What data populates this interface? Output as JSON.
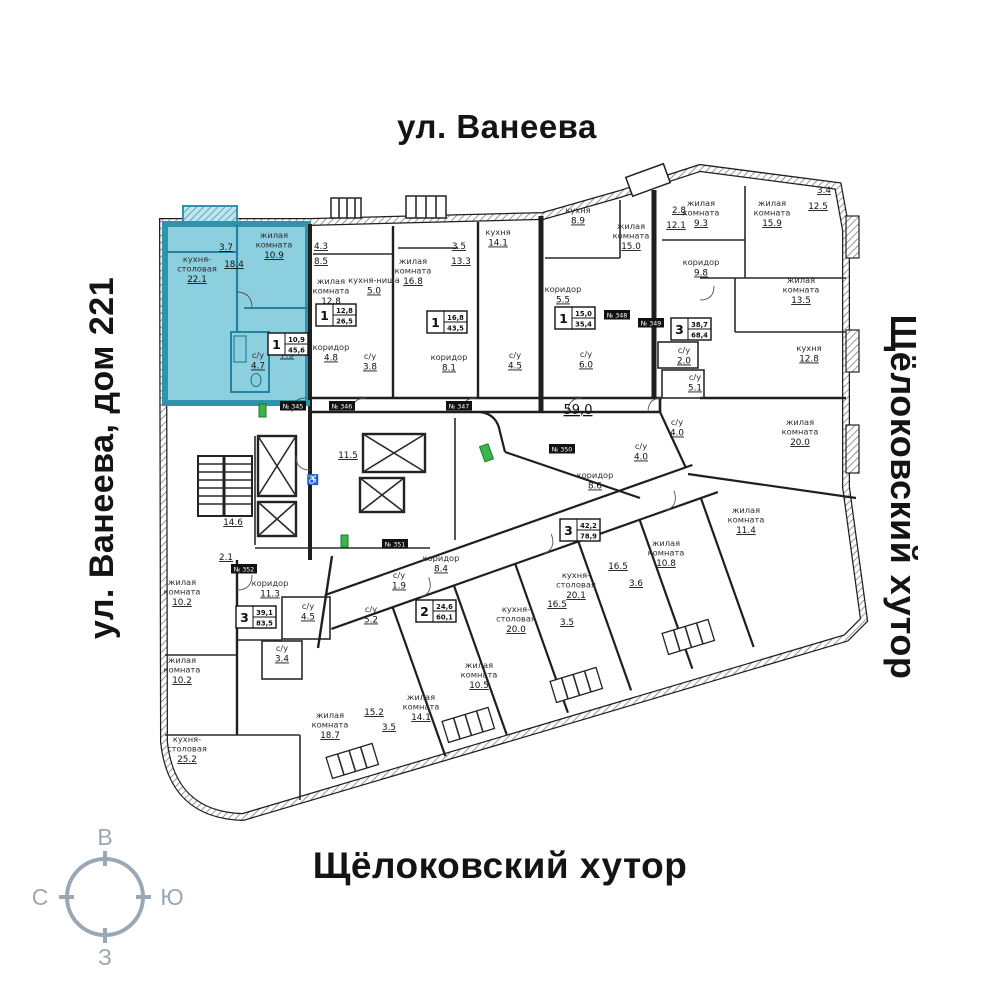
{
  "streets": {
    "top": "ул. Ванеева",
    "left": "ул. Ванеева, дом 221",
    "right": "Щёлоковский хутор",
    "bottom": "Щёлоковский хутор"
  },
  "compass": {
    "top": "В",
    "right": "Ю",
    "bottom": "З",
    "left": "С"
  },
  "colors": {
    "highlight_fill": "#7cc8da",
    "highlight_wall": "#2f93ac",
    "exit_green": "#3cb54a",
    "wall": "#1f1f1f",
    "compass": "#9aa7b4"
  },
  "plan": {
    "rooms": [
      {
        "name": "кухня-\nстоловая",
        "area": "22.1",
        "x": 197,
        "y": 262
      },
      {
        "name": "жилая\nкомната",
        "area": "10.9",
        "x": 274,
        "y": 238
      },
      {
        "area": "3.7",
        "x": 226,
        "y": 250
      },
      {
        "area": "18.4",
        "x": 234,
        "y": 267
      },
      {
        "name": "коридор",
        "area": "7.9",
        "x": 287,
        "y": 347
      },
      {
        "name": "с/у",
        "area": "4.7",
        "x": 258,
        "y": 358
      },
      {
        "area": "4.3",
        "x": 321,
        "y": 249
      },
      {
        "area": "8.5",
        "x": 321,
        "y": 264
      },
      {
        "name": "жилая\nкомната",
        "area": "12.8",
        "x": 331,
        "y": 284
      },
      {
        "name": "кухня-ниша",
        "area": "5.0",
        "x": 374,
        "y": 283
      },
      {
        "name": "коридор",
        "area": "4.8",
        "x": 331,
        "y": 350
      },
      {
        "name": "с/у",
        "area": "3.8",
        "x": 370,
        "y": 359
      },
      {
        "area": "3.5",
        "x": 459,
        "y": 249
      },
      {
        "area": "13.3",
        "x": 461,
        "y": 264
      },
      {
        "name": "жилая\nкомната",
        "area": "16.8",
        "x": 413,
        "y": 264
      },
      {
        "name": "коридор",
        "area": "8.1",
        "x": 449,
        "y": 360
      },
      {
        "name": "кухня",
        "area": "14.1",
        "x": 498,
        "y": 235
      },
      {
        "name": "с/у",
        "area": "4.5",
        "x": 515,
        "y": 358
      },
      {
        "name": "кухня",
        "area": "8.9",
        "x": 578,
        "y": 213
      },
      {
        "name": "жилая\nкомната",
        "area": "15.0",
        "x": 631,
        "y": 229
      },
      {
        "area": "2.8",
        "x": 679,
        "y": 213
      },
      {
        "area": "12.1",
        "x": 676,
        "y": 228
      },
      {
        "name": "коридор",
        "area": "5.5",
        "x": 563,
        "y": 292
      },
      {
        "name": "с/у",
        "area": "6.0",
        "x": 586,
        "y": 357
      },
      {
        "name": "жилая\nкомната",
        "area": "9.3",
        "x": 701,
        "y": 206
      },
      {
        "name": "жилая\nкомната",
        "area": "15.9",
        "x": 772,
        "y": 206
      },
      {
        "area": "3.4",
        "x": 824,
        "y": 193
      },
      {
        "area": "12.5",
        "x": 818,
        "y": 209
      },
      {
        "name": "коридор",
        "area": "9.8",
        "x": 701,
        "y": 265
      },
      {
        "name": "жилая\nкомната",
        "area": "13.5",
        "x": 801,
        "y": 283
      },
      {
        "name": "с/у",
        "area": "2.0",
        "x": 684,
        "y": 353
      },
      {
        "name": "с/у",
        "area": "5.1",
        "x": 695,
        "y": 380
      },
      {
        "name": "кухня",
        "area": "12.8",
        "x": 809,
        "y": 351
      },
      {
        "name": "жилая\nкомната",
        "area": "20.0",
        "x": 800,
        "y": 425
      },
      {
        "name": "с/у",
        "area": "4.0",
        "x": 677,
        "y": 425
      },
      {
        "name": "с/у",
        "area": "4.0",
        "x": 641,
        "y": 449
      },
      {
        "name": "коридор",
        "area": "8.6",
        "x": 595,
        "y": 478
      },
      {
        "name": "жилая\nкомната",
        "area": "11.4",
        "x": 746,
        "y": 513
      },
      {
        "name": "жилая\nкомната",
        "area": "10.8",
        "x": 666,
        "y": 546
      },
      {
        "name": "кухня-\nстоловая",
        "area": "20.1",
        "x": 576,
        "y": 578
      },
      {
        "area": "16.5",
        "x": 618,
        "y": 569
      },
      {
        "area": "3.6",
        "x": 636,
        "y": 586
      },
      {
        "name": "коридор",
        "area": "8.4",
        "x": 441,
        "y": 561
      },
      {
        "name": "с/у",
        "area": "1.9",
        "x": 399,
        "y": 578
      },
      {
        "name": "с/у",
        "area": "5.2",
        "x": 371,
        "y": 612
      },
      {
        "name": "кухня-\nстоловая",
        "area": "20.0",
        "x": 516,
        "y": 612
      },
      {
        "area": "16.5",
        "x": 557,
        "y": 607
      },
      {
        "area": "3.5",
        "x": 567,
        "y": 625
      },
      {
        "name": "жилая\nкомната",
        "area": "10.5",
        "x": 479,
        "y": 668
      },
      {
        "name": "жилая\nкомната",
        "area": "14.1",
        "x": 421,
        "y": 700
      },
      {
        "name": "коридор",
        "area": "11.3",
        "x": 270,
        "y": 586
      },
      {
        "name": "с/у",
        "area": "4.5",
        "x": 308,
        "y": 609
      },
      {
        "name": "с/у",
        "area": "3.4",
        "x": 282,
        "y": 651
      },
      {
        "name": "жилая\nкомната",
        "area": "10.2",
        "x": 182,
        "y": 585
      },
      {
        "name": "жилая\nкомната",
        "area": "10.2",
        "x": 182,
        "y": 663
      },
      {
        "name": "кухня-\nстоловая",
        "area": "25.2",
        "x": 187,
        "y": 742
      },
      {
        "name": "жилая\nкомната",
        "area": "18.7",
        "x": 330,
        "y": 718
      },
      {
        "area": "15.2",
        "x": 374,
        "y": 715
      },
      {
        "area": "3.5",
        "x": 389,
        "y": 730
      },
      {
        "area": "59,0",
        "x": 578,
        "y": 414,
        "big": true
      },
      {
        "area": "11.5",
        "x": 348,
        "y": 458
      },
      {
        "area": "14.6",
        "x": 233,
        "y": 525
      },
      {
        "area": "2.1",
        "x": 226,
        "y": 560
      }
    ],
    "badges": [
      {
        "type": "1",
        "living": "10,9",
        "total": "45,6",
        "x": 268,
        "y": 333
      },
      {
        "type": "1",
        "living": "12,8",
        "total": "26,5",
        "x": 316,
        "y": 304
      },
      {
        "type": "1",
        "living": "16,8",
        "total": "43,5",
        "x": 427,
        "y": 311
      },
      {
        "type": "1",
        "living": "15,0",
        "total": "35,4",
        "x": 555,
        "y": 307
      },
      {
        "type": "3",
        "living": "38,7",
        "total": "68,4",
        "x": 671,
        "y": 318
      },
      {
        "type": "3",
        "living": "42,2",
        "total": "78,9",
        "x": 560,
        "y": 519
      },
      {
        "type": "2",
        "living": "24,6",
        "total": "60,1",
        "x": 416,
        "y": 600
      },
      {
        "type": "3",
        "living": "39,1",
        "total": "83,5",
        "x": 236,
        "y": 606
      }
    ],
    "plates": [
      {
        "label": "№ 345",
        "x": 280,
        "y": 401
      },
      {
        "label": "№ 346",
        "x": 329,
        "y": 401
      },
      {
        "label": "№ 347",
        "x": 446,
        "y": 401
      },
      {
        "label": "№ 348",
        "x": 604,
        "y": 310
      },
      {
        "label": "№ 349",
        "x": 638,
        "y": 318
      },
      {
        "label": "№ 350",
        "x": 549,
        "y": 444
      },
      {
        "label": "№ 351",
        "x": 382,
        "y": 539
      },
      {
        "label": "№ 352",
        "x": 231,
        "y": 564
      }
    ]
  }
}
